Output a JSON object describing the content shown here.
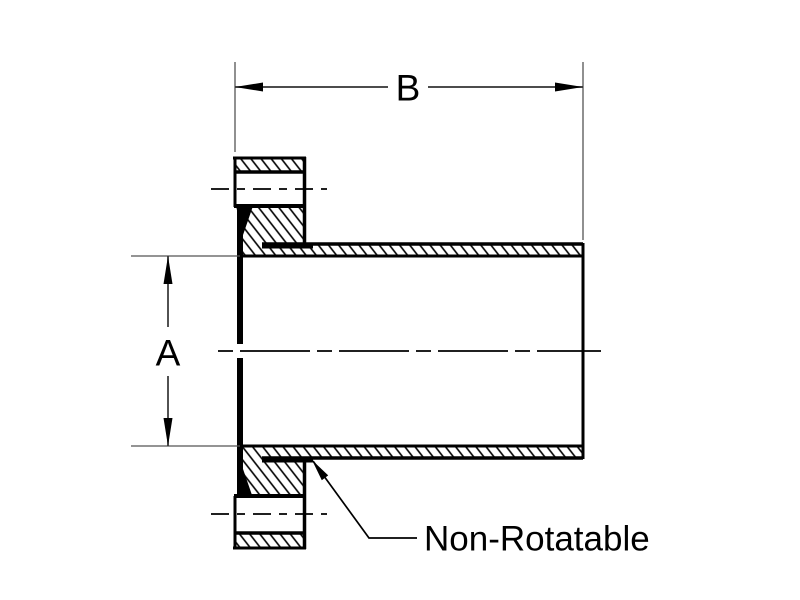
{
  "page": {
    "kind": "technical-drawing",
    "description": "Cross-section drawing of a non-rotatable bored flange welded to a tube, with dimensions A (bore diameter) and B (overall length)",
    "background_color": "#ffffff",
    "line_color": "#000000",
    "dim_line_color": "#333333",
    "ext_line_color": "#555555"
  },
  "diagram": {
    "labels": {
      "dim_horizontal": "B",
      "dim_vertical": "A",
      "leader": "Non-Rotatable"
    }
  }
}
